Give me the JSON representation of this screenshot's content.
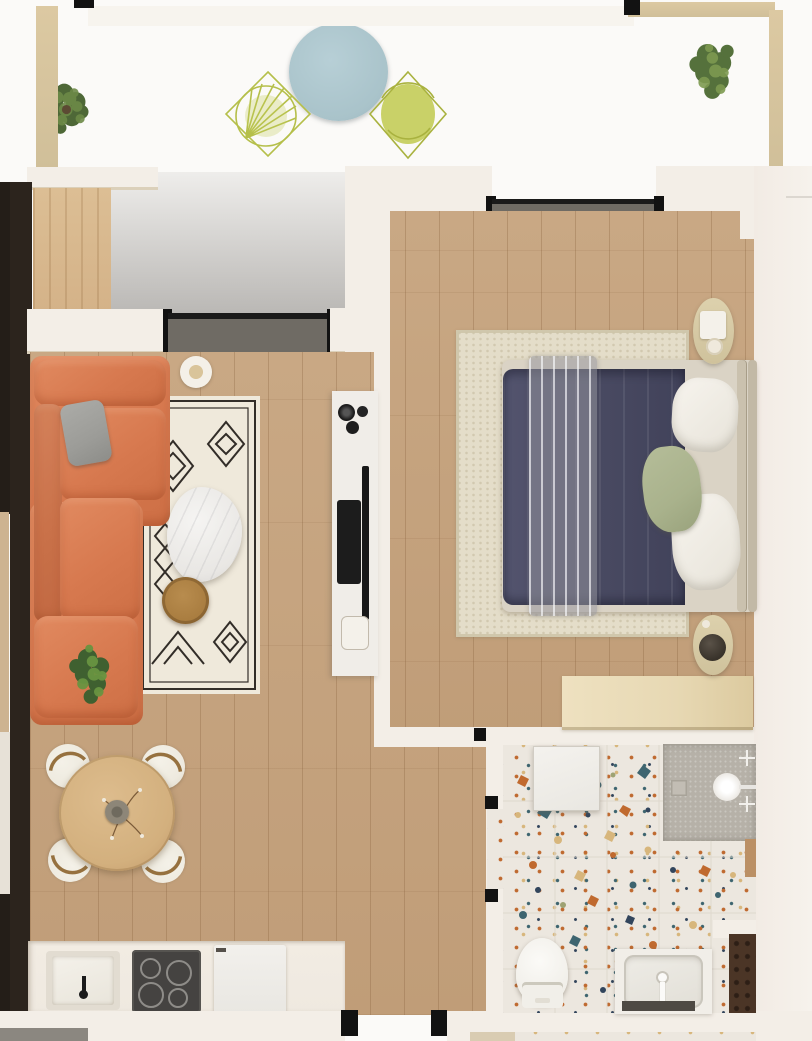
{
  "scene": {
    "kind": "apartment floor plan, top-down 3D render",
    "visible_text": "none"
  },
  "palette": {
    "exterior": "#fbfaf8",
    "wall": "#f3eee7",
    "wallBright": "#f7f4ee",
    "beigeWall": "#d0bf99",
    "darkWall": "#2c241d",
    "tile": "#8f8c85",
    "woodFloor": "#c9a884",
    "woodDoor": "#d4b288",
    "sofa": "#d7794f",
    "pillowGray": "#9c9c98",
    "rug": "#efe9db",
    "rugLine": "#322d28",
    "marble": "#e9e7e4",
    "woodTable": "#a87c3f",
    "plant": "#4e6837",
    "plantLight": "#6d8a47",
    "diningTable": "#d3b07e",
    "chairBoucle": "#eeeadf",
    "chairWood": "#96713f",
    "counter": "#efe9e0",
    "cooktop": "#454341",
    "bedRug": "#e4ddc9",
    "duvet": "#4a4b63",
    "mattress": "#dad3c5",
    "headboard": "#cac1ae",
    "pillowGreen": "#a9b28c",
    "throw": "#97969a",
    "nightstand": "#cfc29c",
    "desk": "#e7d8b3",
    "terrazzo": "#ece7df",
    "shower": "#b6b1a8",
    "cabinetBrown": "#4b3526",
    "tvBlack": "#181818",
    "console": "#f0ede8",
    "balconyTable": "#a9c3ca",
    "chairLime": "#b5bf4a",
    "track": "#1a1a1a",
    "jamb": "#121212"
  },
  "rooms": {
    "terrace": {
      "label": "Terrace",
      "items": [
        "round-coffee-table",
        "wire-chair",
        "wire-chair",
        "plant",
        "plant"
      ]
    },
    "living": {
      "label": "Living room",
      "items": [
        "corner-sofa",
        "gray-pillow",
        "area-rug",
        "marble-coffee-table",
        "round-side-table",
        "plant",
        "candle-tray",
        "tv-console",
        "tv"
      ]
    },
    "dining": {
      "label": "Dining area",
      "items": [
        "round-dining-table",
        "vase",
        "dining-chair",
        "dining-chair",
        "dining-chair",
        "dining-chair"
      ]
    },
    "kitchen": {
      "label": "Kitchen",
      "items": [
        "counter",
        "sink",
        "cooktop",
        "appliance"
      ]
    },
    "bedroom": {
      "label": "Bedroom",
      "items": [
        "double-bed",
        "duvet",
        "throw-blanket",
        "pillows",
        "green-pillow",
        "rug",
        "nightstand",
        "nightstand",
        "desk"
      ]
    },
    "bathroom": {
      "label": "Bathroom",
      "items": [
        "washing-machine",
        "shower",
        "toilet",
        "vanity-sink",
        "cabinet"
      ]
    },
    "entry": {
      "label": "Entry",
      "items": [
        "entry-door-opening",
        "closet-door"
      ]
    }
  }
}
